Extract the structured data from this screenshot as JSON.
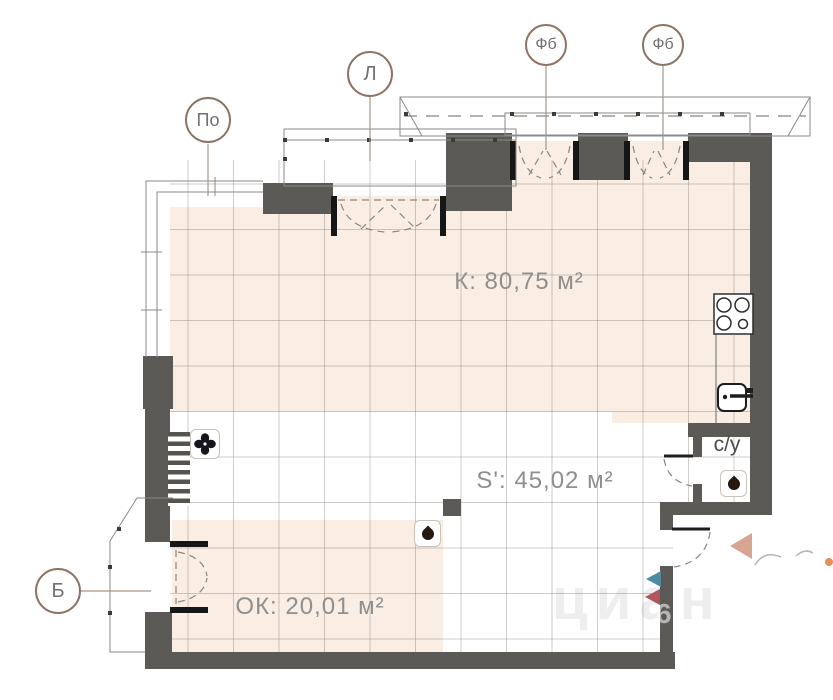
{
  "rooms": [
    {
      "name": "kitchen-living-room",
      "label": "К: 80,75 м²"
    },
    {
      "name": "apartment-area",
      "label": "S': 45,02 м²"
    },
    {
      "name": "window-room",
      "label": "ОК: 20,01 м²"
    },
    {
      "name": "bathroom",
      "label": "с/у"
    }
  ],
  "markers": [
    {
      "name": "panoramic-window",
      "label": "По"
    },
    {
      "name": "loggia",
      "label": "Л"
    },
    {
      "name": "french-balcony-1",
      "label": "Фб"
    },
    {
      "name": "french-balcony-2",
      "label": "Фб"
    },
    {
      "name": "balcony",
      "label": "Б"
    }
  ],
  "watermark": {
    "text": "циан",
    "digit": "6"
  },
  "icons": [
    {
      "name": "fan-icon",
      "meaning": "kitchen exhaust fan"
    },
    {
      "name": "water-drop-icon",
      "meaning": "wet point"
    },
    {
      "name": "water-drop-icon",
      "meaning": "wet point (bathroom)"
    },
    {
      "name": "stove-icon",
      "meaning": "4-burner stove"
    },
    {
      "name": "sink-icon",
      "meaning": "kitchen sink"
    },
    {
      "name": "entrance-arrow",
      "meaning": "entrance direction"
    }
  ],
  "colors": {
    "wall": "#5b5a56",
    "floor_tile": "#f9ede4",
    "grid_line": "#b9b3ad",
    "marker_border": "#8d7365",
    "label_text": "#8f8f8f",
    "triangle_teal": "#4f8ba3",
    "triangle_red": "#b4575c",
    "triangle_beige": "#d8a593",
    "fixture_black": "#1c1c22"
  }
}
